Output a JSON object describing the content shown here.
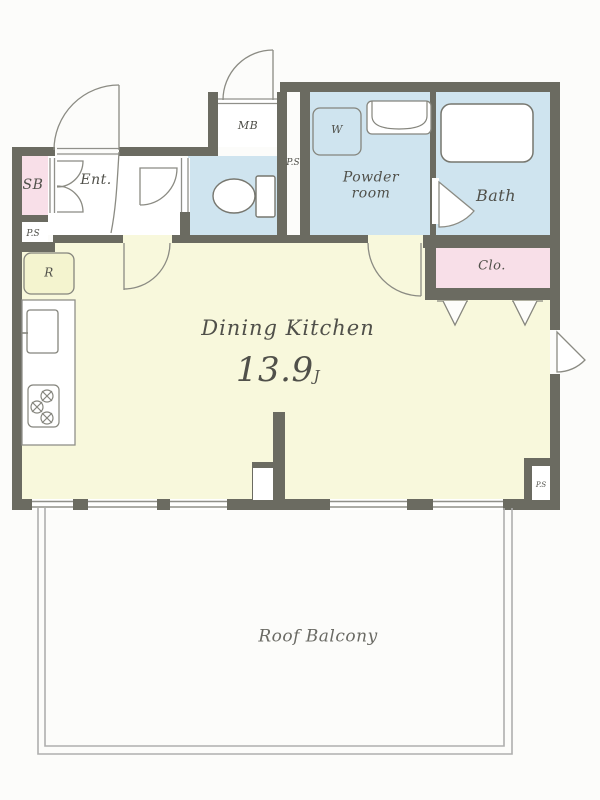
{
  "title": "apartment floor plan",
  "colors": {
    "wall": "#6b6b61",
    "dining_kitchen_fill": "#f8f8dc",
    "wet_room_fill": "#cfe4ef",
    "closet_fill": "#f8dfe8",
    "appliance_fill": "#f4f4cf",
    "thin_line": "#90908a",
    "balcony_line": "#aeaeae",
    "text": "#50504a"
  },
  "rooms": {
    "dining_kitchen": {
      "name": "Dining Kitchen",
      "area_value": "13.9",
      "area_unit": "J"
    },
    "powder_room": {
      "line1": "Powder",
      "line2": "room"
    },
    "bath": {
      "name": "Bath"
    },
    "closet": {
      "name": "Clo."
    },
    "entrance": {
      "name": "Ent."
    },
    "roof_balcony": {
      "name": "Roof Balcony"
    }
  },
  "labels": {
    "shoe_box": "SB",
    "pipe_space": "P.S",
    "meter_box": "MB",
    "washing_machine": "W",
    "refrigerator": "R"
  }
}
